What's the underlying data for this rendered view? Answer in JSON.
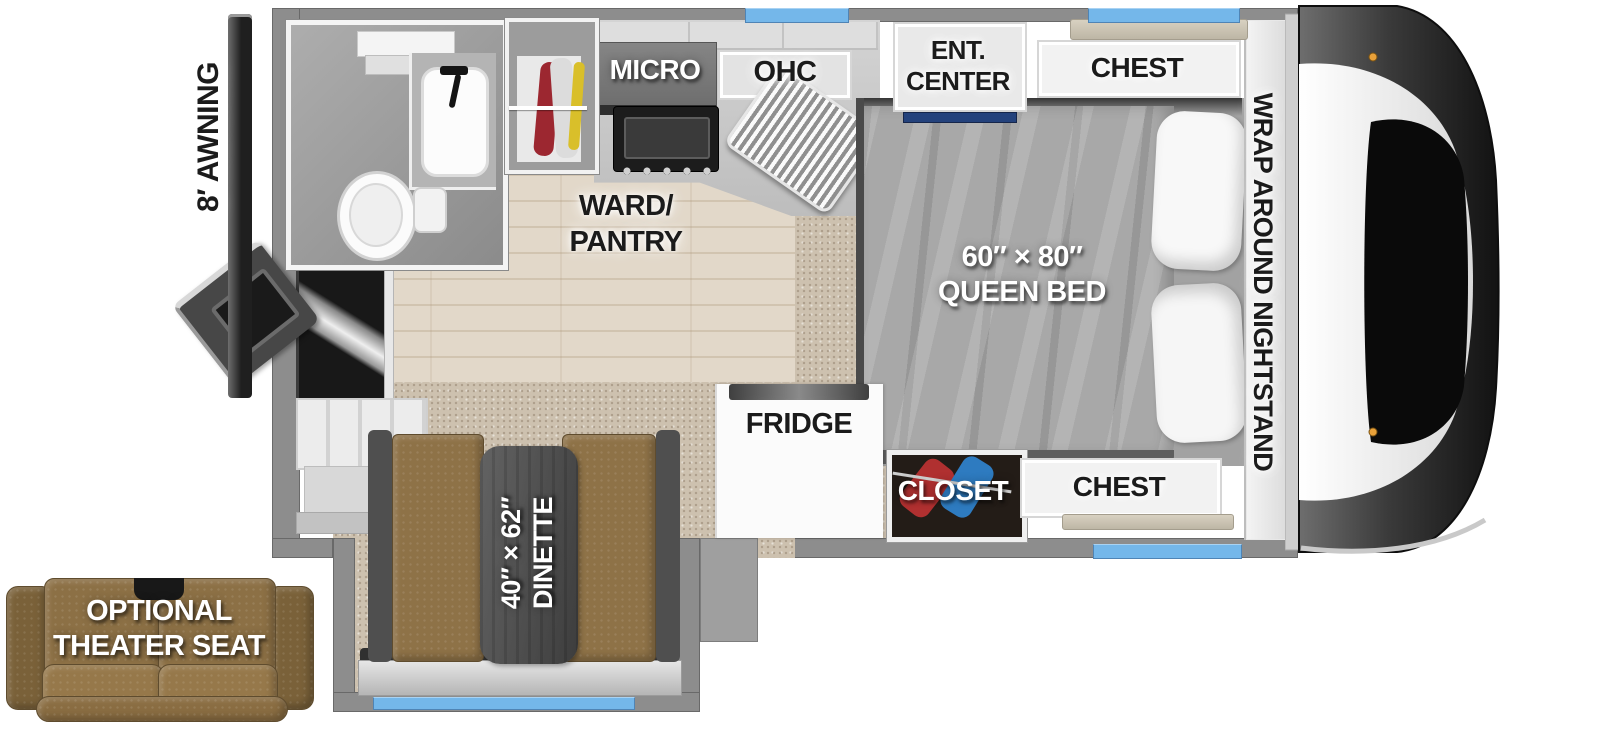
{
  "plan": {
    "exterior": {
      "awning_label": "8′ AWNING"
    },
    "kitchen": {
      "micro_label": "MICRO",
      "ohc_label": "OHC",
      "ward_pantry_line1": "WARD/",
      "ward_pantry_line2": "PANTRY",
      "fridge_label": "FRIDGE"
    },
    "bedroom": {
      "ent_center_line1": "ENT.",
      "ent_center_line2": "CENTER",
      "chest_top_label": "CHEST",
      "chest_bottom_label": "CHEST",
      "closet_label": "CLOSET",
      "nightstand_label": "WRAP AROUND NIGHTSTAND",
      "bed_size_label": "60″ × 80″",
      "bed_type_label": "QUEEN BED"
    },
    "dinette": {
      "size_label": "40″ × 62″",
      "type_label": "DINETTE"
    },
    "options": {
      "theater_line1": "OPTIONAL",
      "theater_line2": "THEATER SEAT"
    },
    "colors": {
      "window_blue": "#74b7ea",
      "wall_gray": "#8d8d8d",
      "wood_floor": "#e2d8c9",
      "carpet": "#cdc1af",
      "bench_brown": "#8e7247",
      "theater_brown": "#8c7045",
      "blanket_gray": "#a8a8a8",
      "ent_center_accent_navy": "#24427c",
      "closet_clothes_red": "#b03030",
      "closet_clothes_blue": "#2e7bc0"
    }
  }
}
